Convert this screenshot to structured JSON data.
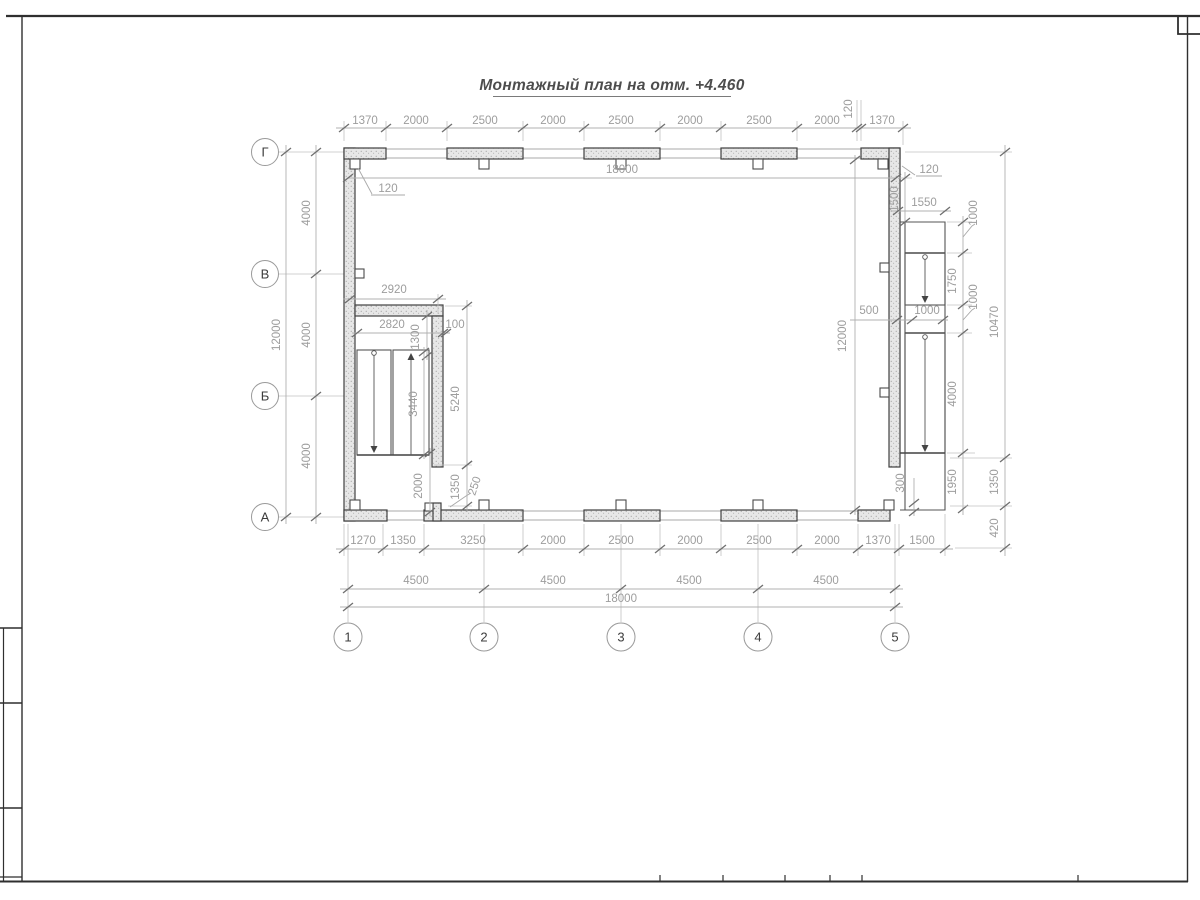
{
  "title": "Монтажный план на отм. +4.460",
  "axes": {
    "rows": [
      "Г",
      "В",
      "Б",
      "А"
    ],
    "cols": [
      "1",
      "2",
      "3",
      "4",
      "5"
    ]
  },
  "dims": {
    "top_chain": [
      "1370",
      "2000",
      "2500",
      "2000",
      "2500",
      "2000",
      "2500",
      "2000",
      "120",
      "1370"
    ],
    "top_overall": "18000",
    "leader_tl": "120",
    "left_chain": [
      "4000",
      "4000",
      "4000"
    ],
    "left_overall": "12000",
    "bottom_chain": [
      "1270",
      "1350",
      "3250",
      "2000",
      "2500",
      "2000",
      "2500",
      "2000",
      "1370",
      "1500"
    ],
    "bottom_spans": [
      "4500",
      "4500",
      "4500",
      "4500"
    ],
    "bottom_overall": "18000",
    "interior_height": "12000",
    "right": {
      "leader": "120",
      "v1500": "1500",
      "h1550": "1550",
      "chain": [
        "1000",
        "1750",
        "1000",
        "4000",
        "1950"
      ],
      "outer": [
        "10470",
        "1350",
        "420"
      ],
      "mid": [
        "500",
        "1000"
      ],
      "b300": "300"
    },
    "stair": {
      "w2920": "2920",
      "w2820": "2820",
      "v1300": "1300",
      "g100": "100",
      "f3440": "3440",
      "t5240": "5240",
      "b2000": "2000",
      "b1350": "1350",
      "o250": "250"
    }
  }
}
